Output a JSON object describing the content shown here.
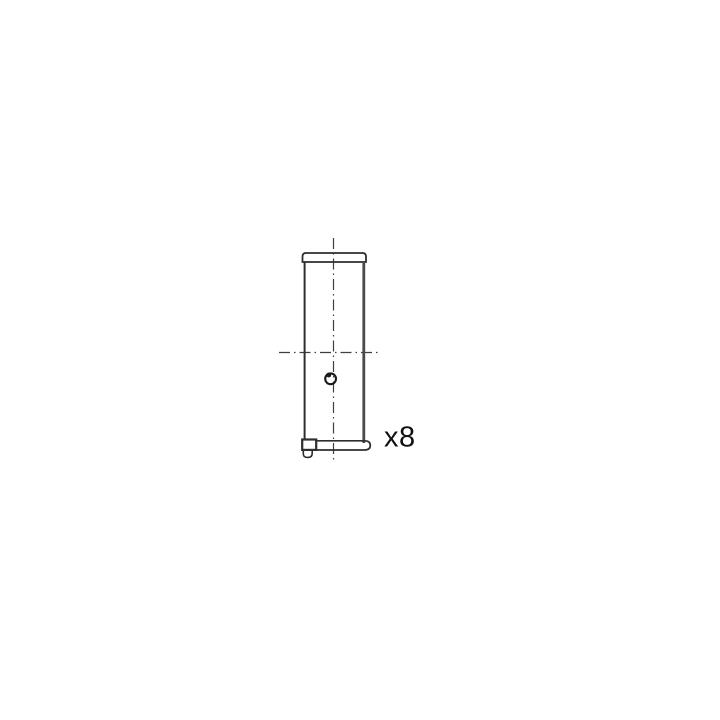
{
  "drawing": {
    "subject": "bearing-shell-side-view",
    "quantity_label": "x8",
    "colors": {
      "background": "#ffffff",
      "line": "#2e2e2e",
      "right_edge": "#4a4a4a",
      "centerline": "#3f3f3f",
      "hole": "#1a1a1a",
      "text": "#111111"
    }
  }
}
